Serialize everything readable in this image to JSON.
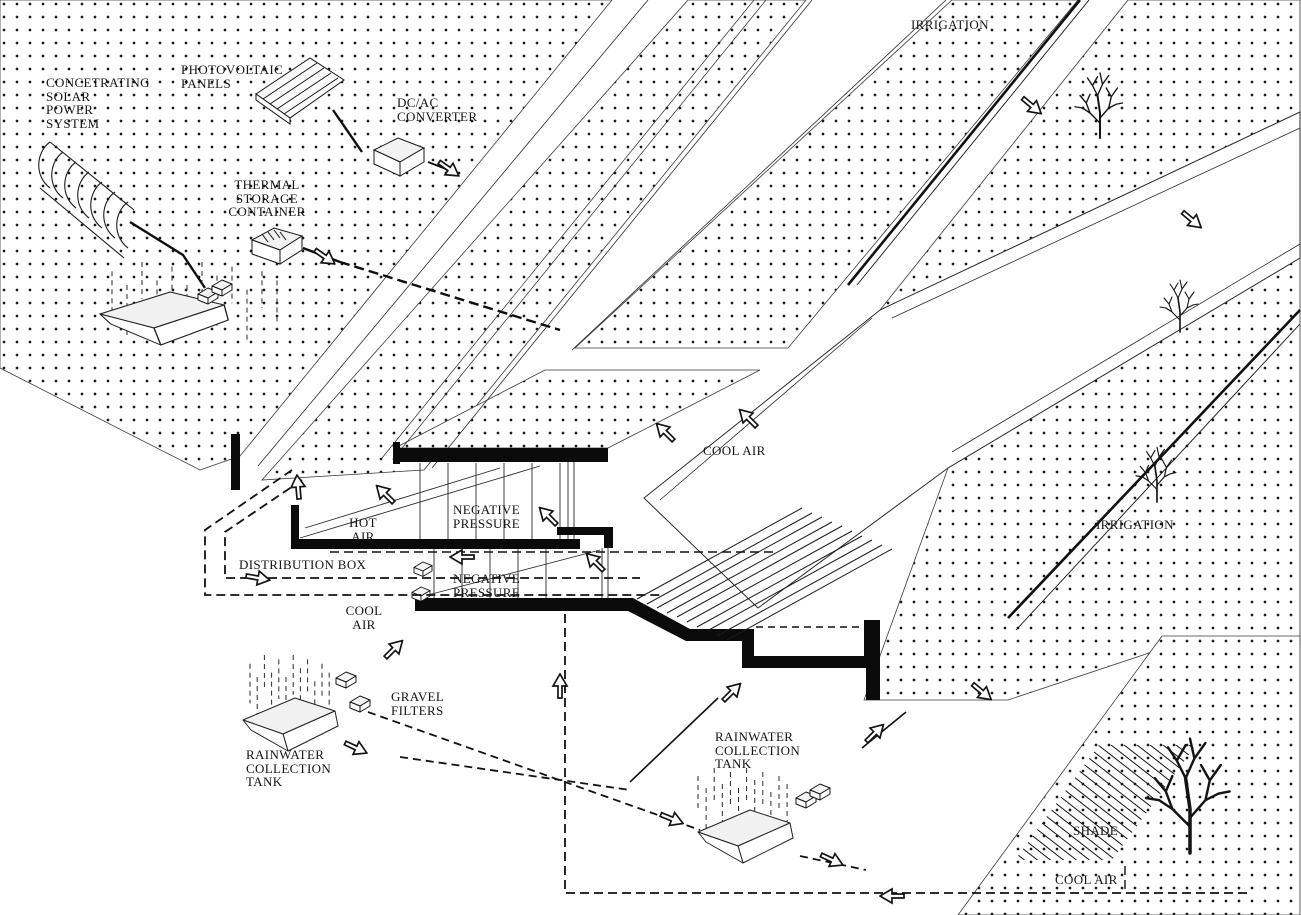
{
  "page": {
    "title": "Environmental systems axonometric diagram",
    "description": "Sectional axonometric of an earth-sheltered building showing solar power, rainwater collection, irrigation and passive cooling flows"
  },
  "colors": {
    "ink": "#141414",
    "paper": "#ffffff",
    "light_fill": "#f1f1f1"
  },
  "labels": {
    "csp": {
      "text": "CONCETRATING\nSOLAR\nPOWER\nSYSTEM"
    },
    "pv": {
      "text": "PHOTOVOLTAIC\nPANELS"
    },
    "dcac": {
      "text": "DC/AC\nCONVERTER"
    },
    "thermal": {
      "text": "THERMAL\nSTORAGE\nCONTAINER"
    },
    "irrigation_top": {
      "text": "IRRIGATION"
    },
    "irrigation_right": {
      "text": "IRRIGATION"
    },
    "cool_air_center": {
      "text": "COOL AIR"
    },
    "hot_air": {
      "text": "HOT\nAIR"
    },
    "negative_pressure_upper": {
      "text": "NEGATIVE\nPRESSURE"
    },
    "negative_pressure_lower": {
      "text": "NEGATIVE\nPRESSURE"
    },
    "distribution_box": {
      "text": "DISTRIBUTION BOX"
    },
    "cool_air_left": {
      "text": "COOL\nAIR"
    },
    "gravel_filters": {
      "text": "GRAVEL\nFILTERS"
    },
    "rainwater_left": {
      "text": "RAINWATER\nCOLLECTION\nTANK"
    },
    "rainwater_right": {
      "text": "RAINWATER\nCOLLECTION\nTANK"
    },
    "shade": {
      "text": "SHADE"
    },
    "cool_air_bottom": {
      "text": "COOL AIR"
    }
  },
  "icons": [
    "solar-trough-icon",
    "pv-panels-icon",
    "dc-ac-converter-icon",
    "thermal-storage-icon",
    "collection-tank-icon",
    "rain-icon",
    "gravel-filter-icon",
    "distribution-box-icon",
    "tree-icon",
    "flow-arrow-icon",
    "shade-hatch-icon"
  ]
}
